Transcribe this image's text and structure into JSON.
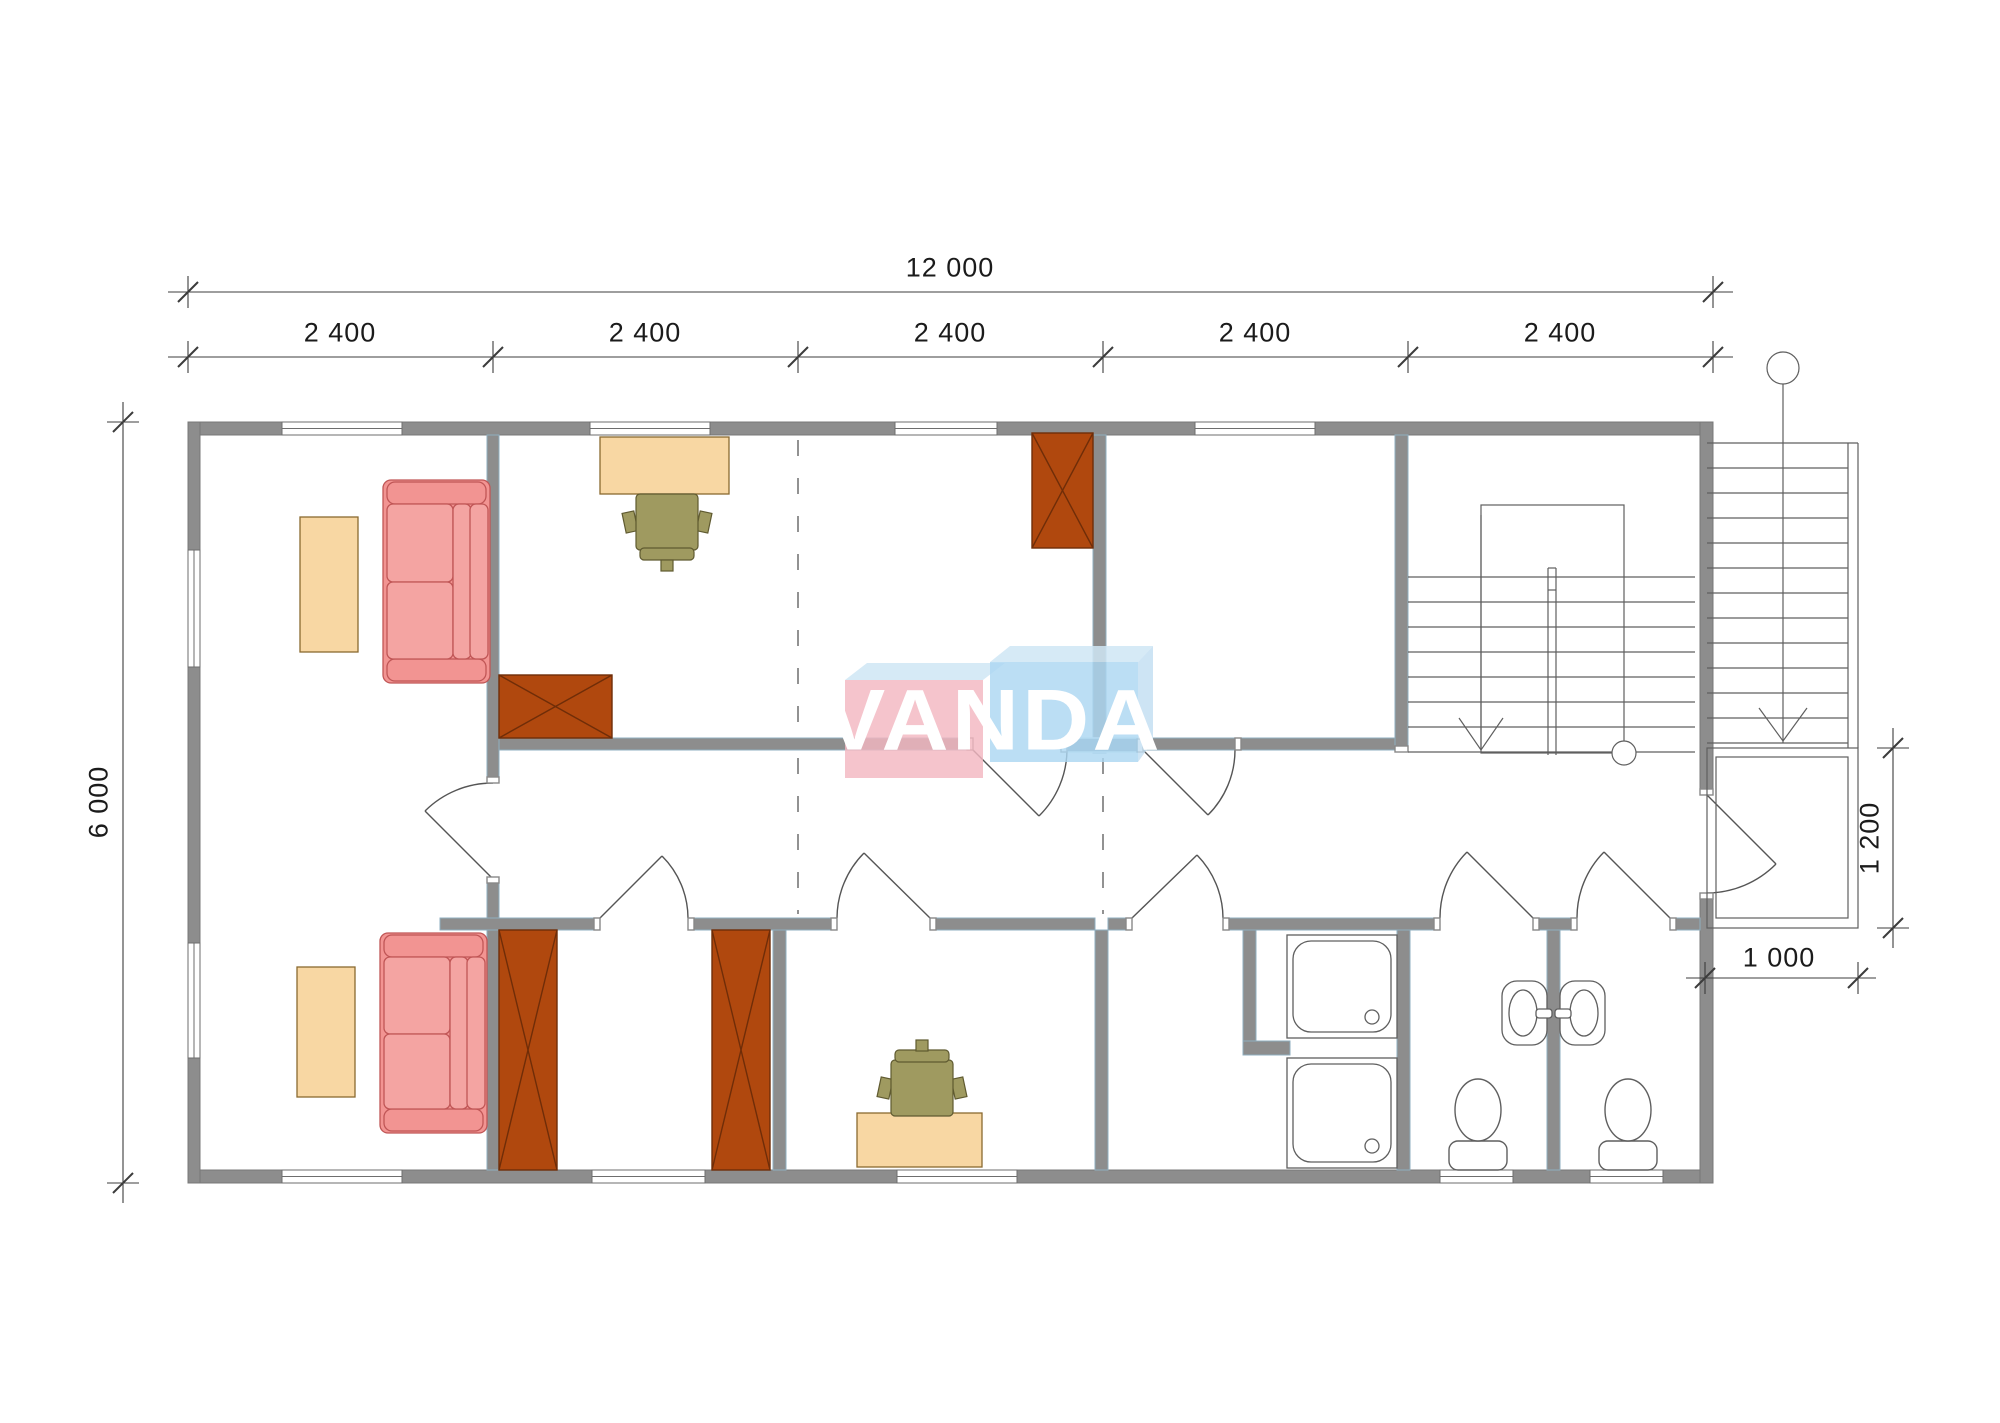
{
  "watermark": {
    "text": "VANDA",
    "pink_box_color": "#F3B7C1",
    "blue_box_color": "#ACD7F1",
    "bevel_color": "#CFE6F5"
  },
  "dimensions": {
    "overall_width": "12 000",
    "modules": [
      "2 400",
      "2 400",
      "2 400",
      "2 400",
      "2 400"
    ],
    "overall_depth": "6 000",
    "entry_landing_depth": "1 200",
    "entry_landing_width": "1 000"
  },
  "colors": {
    "wall": "#8D8D8D",
    "wall_outline": "#8FAFC0",
    "wall_accent": "#7E95A6",
    "furniture_wood": "#F8D7A3",
    "furniture_wood_outline": "#8A6A30",
    "sofa": "#F29492",
    "sofa_cushion": "#F4A4A2",
    "sofa_outline": "#C05656",
    "wardrobe": "#B0480E",
    "wardrobe_outline": "#6F2D08",
    "chair": "#9F9A60",
    "chair_outline": "#5F5A30",
    "drawing_line": "#555555",
    "dimension_text": "#1B1B1B"
  }
}
